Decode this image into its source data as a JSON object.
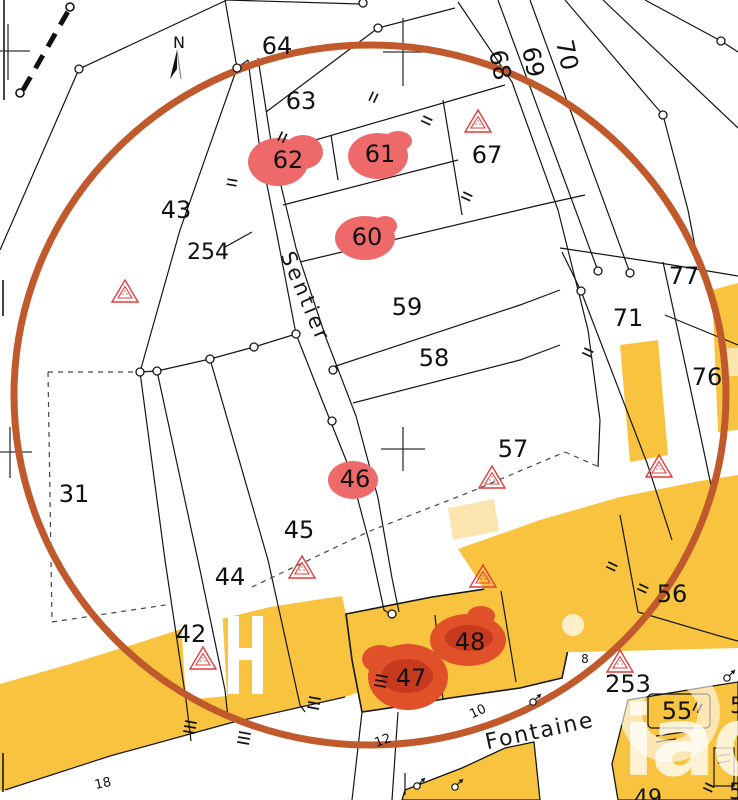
{
  "map": {
    "north": "N",
    "watermark_text": "iad",
    "labels": {
      "p31": "31",
      "p42": "42",
      "p43": "43",
      "p44": "44",
      "p45": "45",
      "p46": "46",
      "p47": "47",
      "p48": "48",
      "p55": "55",
      "p56": "56",
      "p57": "57",
      "p58": "58",
      "p59": "59",
      "p60": "60",
      "p61": "61",
      "p62": "62",
      "p63": "63",
      "p64": "64",
      "p67": "67",
      "p68": "68",
      "p69": "69",
      "p70": "70",
      "p71": "71",
      "p76": "76",
      "p77": "77",
      "p253": "253",
      "p254": "254"
    },
    "street_labels": {
      "sentier": "Sentier",
      "fontaine": "Fontaine"
    },
    "address_labels": {
      "n8": "8",
      "n10": "10",
      "n12": "12",
      "n18": "18"
    },
    "partial_labels": {
      "a": "49",
      "b": "5",
      "c": "5"
    },
    "colors": {
      "building_fill": "#F8C440",
      "building_light": "#FBE4AD",
      "highlight_circle": "#C05A2C",
      "marker_red": "#EE6A6A",
      "marker_orange": "#E0512A",
      "marker_orange_dark": "#C83A1D",
      "hazard_triangle": "#E03C3C",
      "line": "#151515"
    }
  }
}
